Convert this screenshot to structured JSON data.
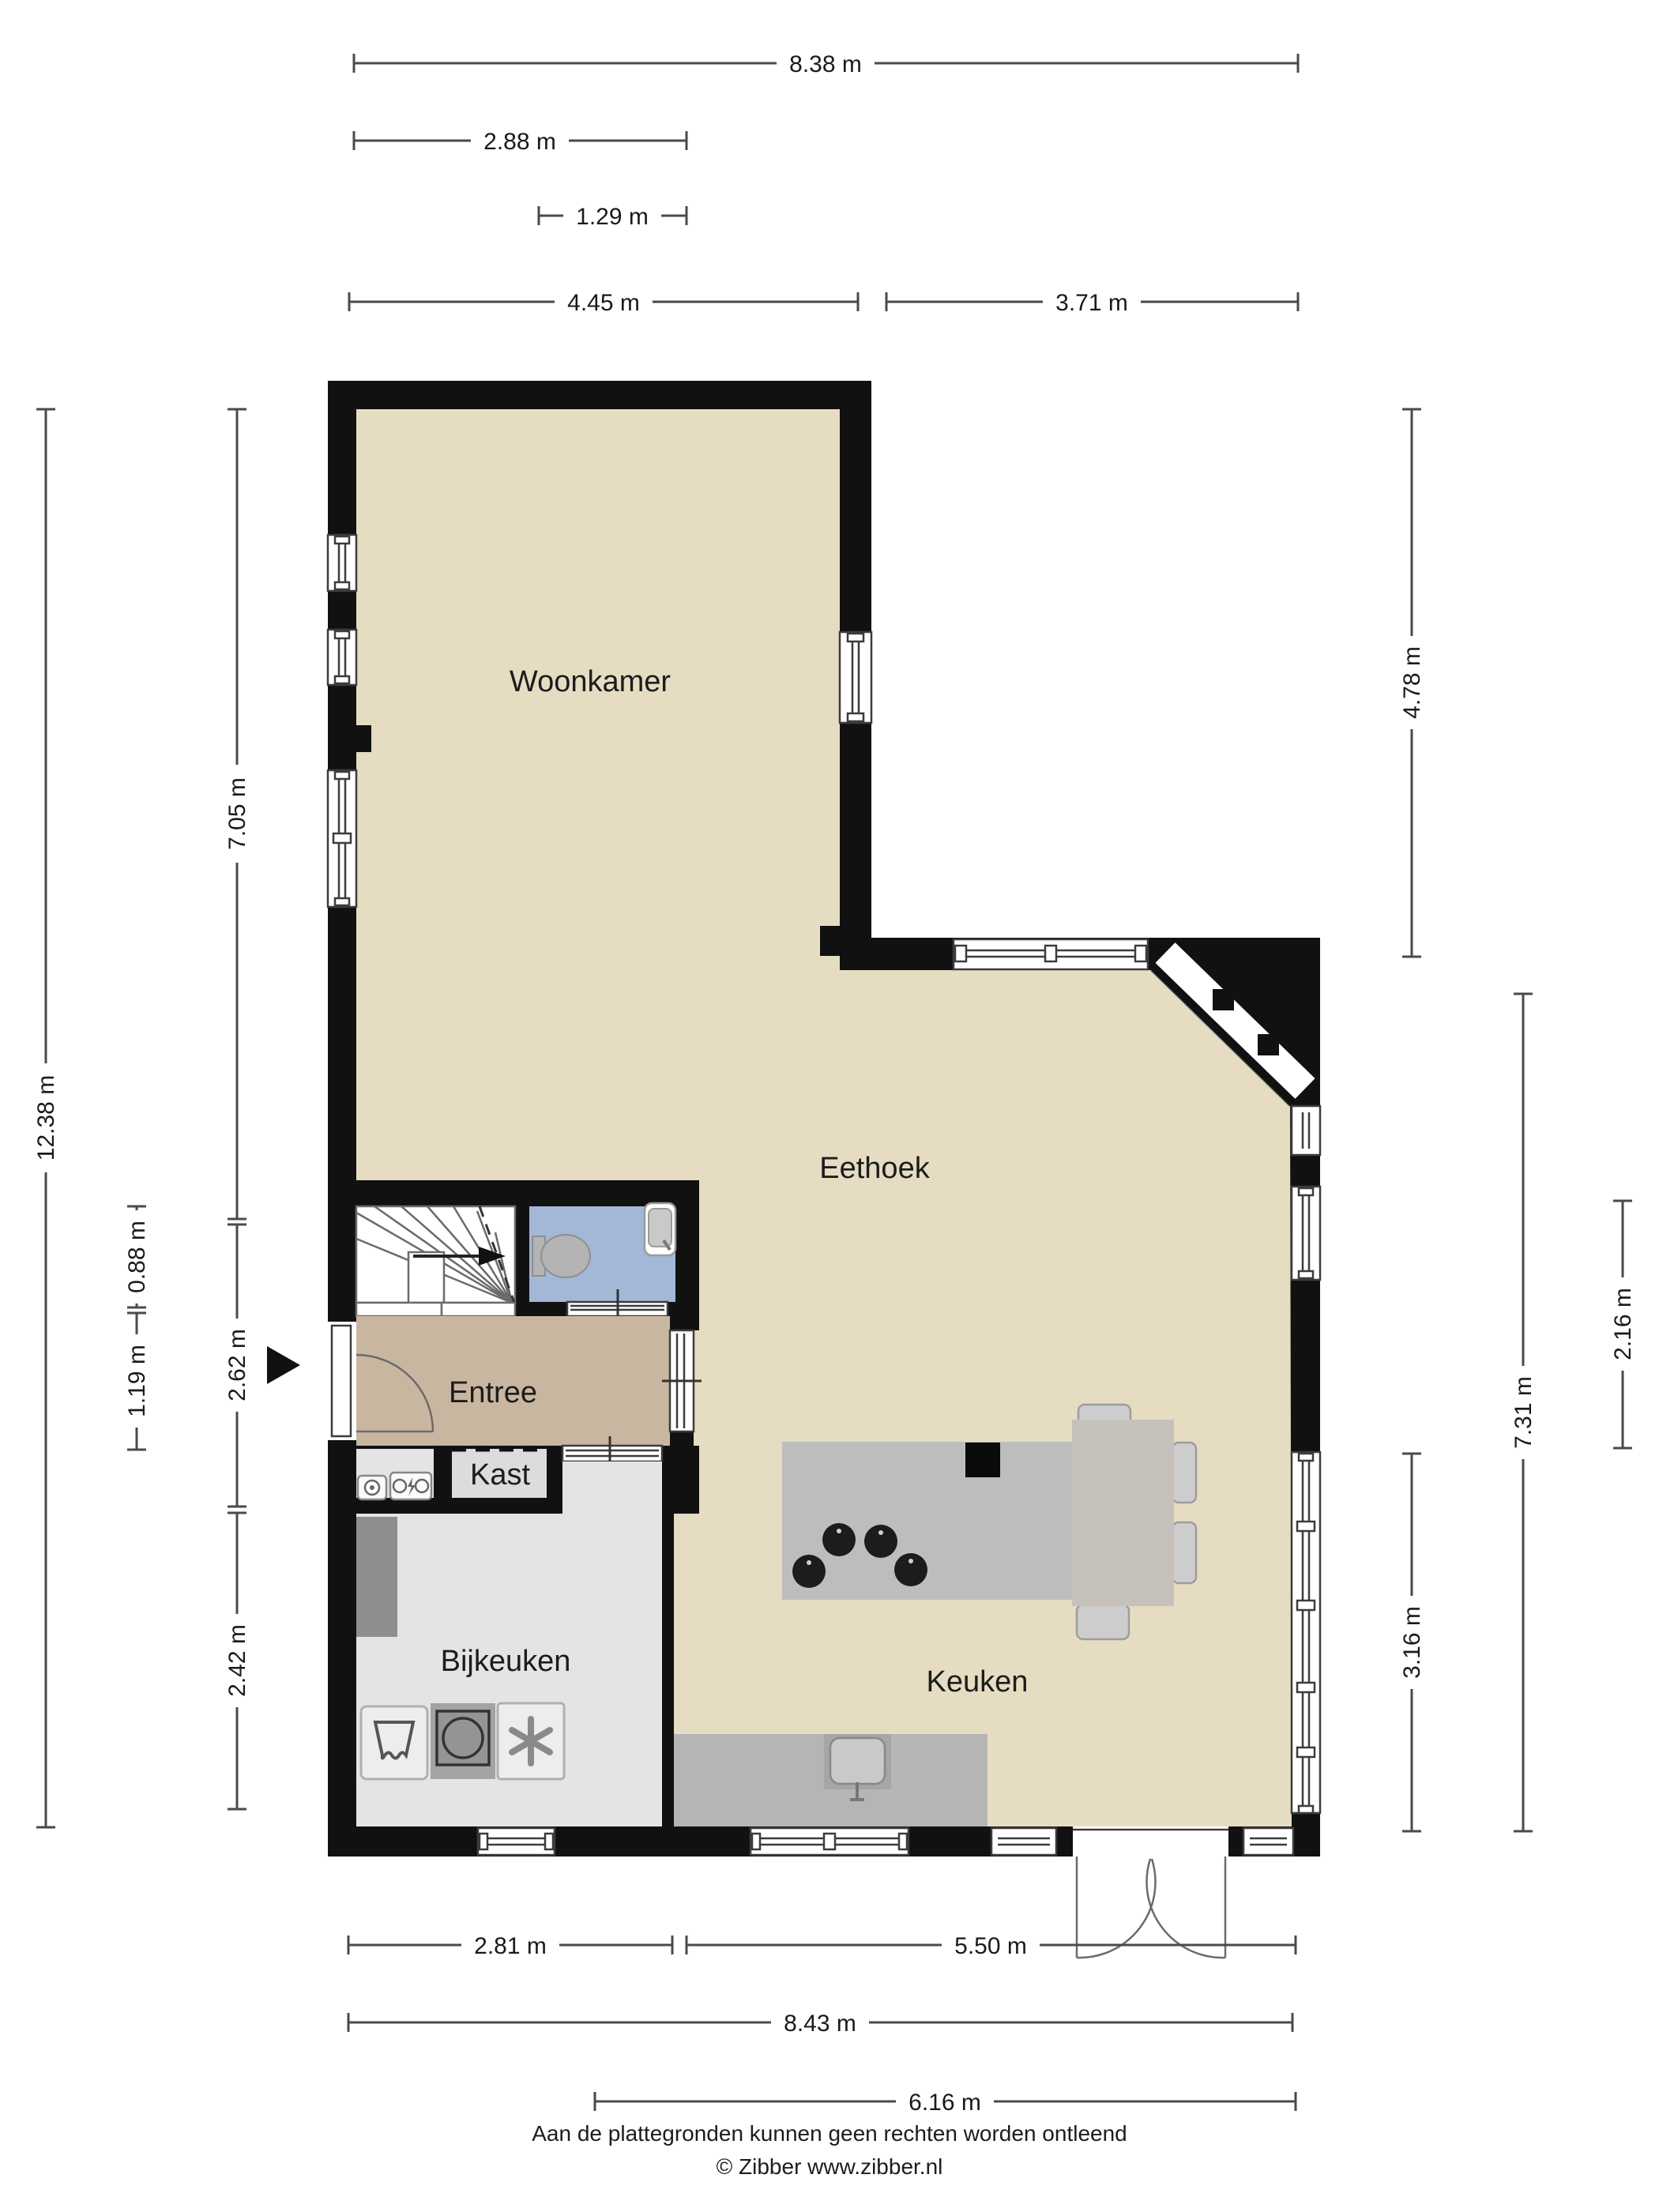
{
  "rooms": {
    "woonkamer": {
      "label": "Woonkamer"
    },
    "eethoek": {
      "label": "Eethoek"
    },
    "entree": {
      "label": "Entree"
    },
    "kast": {
      "label": "Kast"
    },
    "bijkeuken": {
      "label": "Bijkeuken"
    },
    "keuken": {
      "label": "Keuken"
    }
  },
  "dimensions": {
    "top": [
      "8.38 m",
      "2.88 m",
      "1.29 m",
      "4.45 m",
      "3.71 m"
    ],
    "left": [
      "12.38 m",
      "7.05 m",
      "0.88 m",
      "1.19 m",
      "2.62 m",
      "2.42 m"
    ],
    "right": [
      "4.78 m",
      "2.16 m",
      "7.31 m",
      "3.16 m"
    ],
    "bottom": [
      "2.81 m",
      "5.50 m",
      "8.43 m",
      "6.16 m"
    ]
  },
  "footer": {
    "line1": "Aan de plattegronden kunnen geen rechten worden ontleend",
    "line2": "© Zibber www.zibber.nl"
  },
  "colors": {
    "wall": "#111111",
    "floor_main": "#e5dcc2",
    "floor_entree": "#c9b6a1",
    "floor_toilet": "#a3b8d6",
    "floor_utility": "#e4e4e4",
    "floor_kast": "#dcdcdc",
    "counter": "#b5b5b5",
    "island": "#bdbdbd",
    "table": "#c6c2bb",
    "furniture": "#cdcdcd",
    "cabinet_dark": "#8e8e8e",
    "dimension_line": "#4a4a4a",
    "text_color": "#1a1a1a"
  }
}
